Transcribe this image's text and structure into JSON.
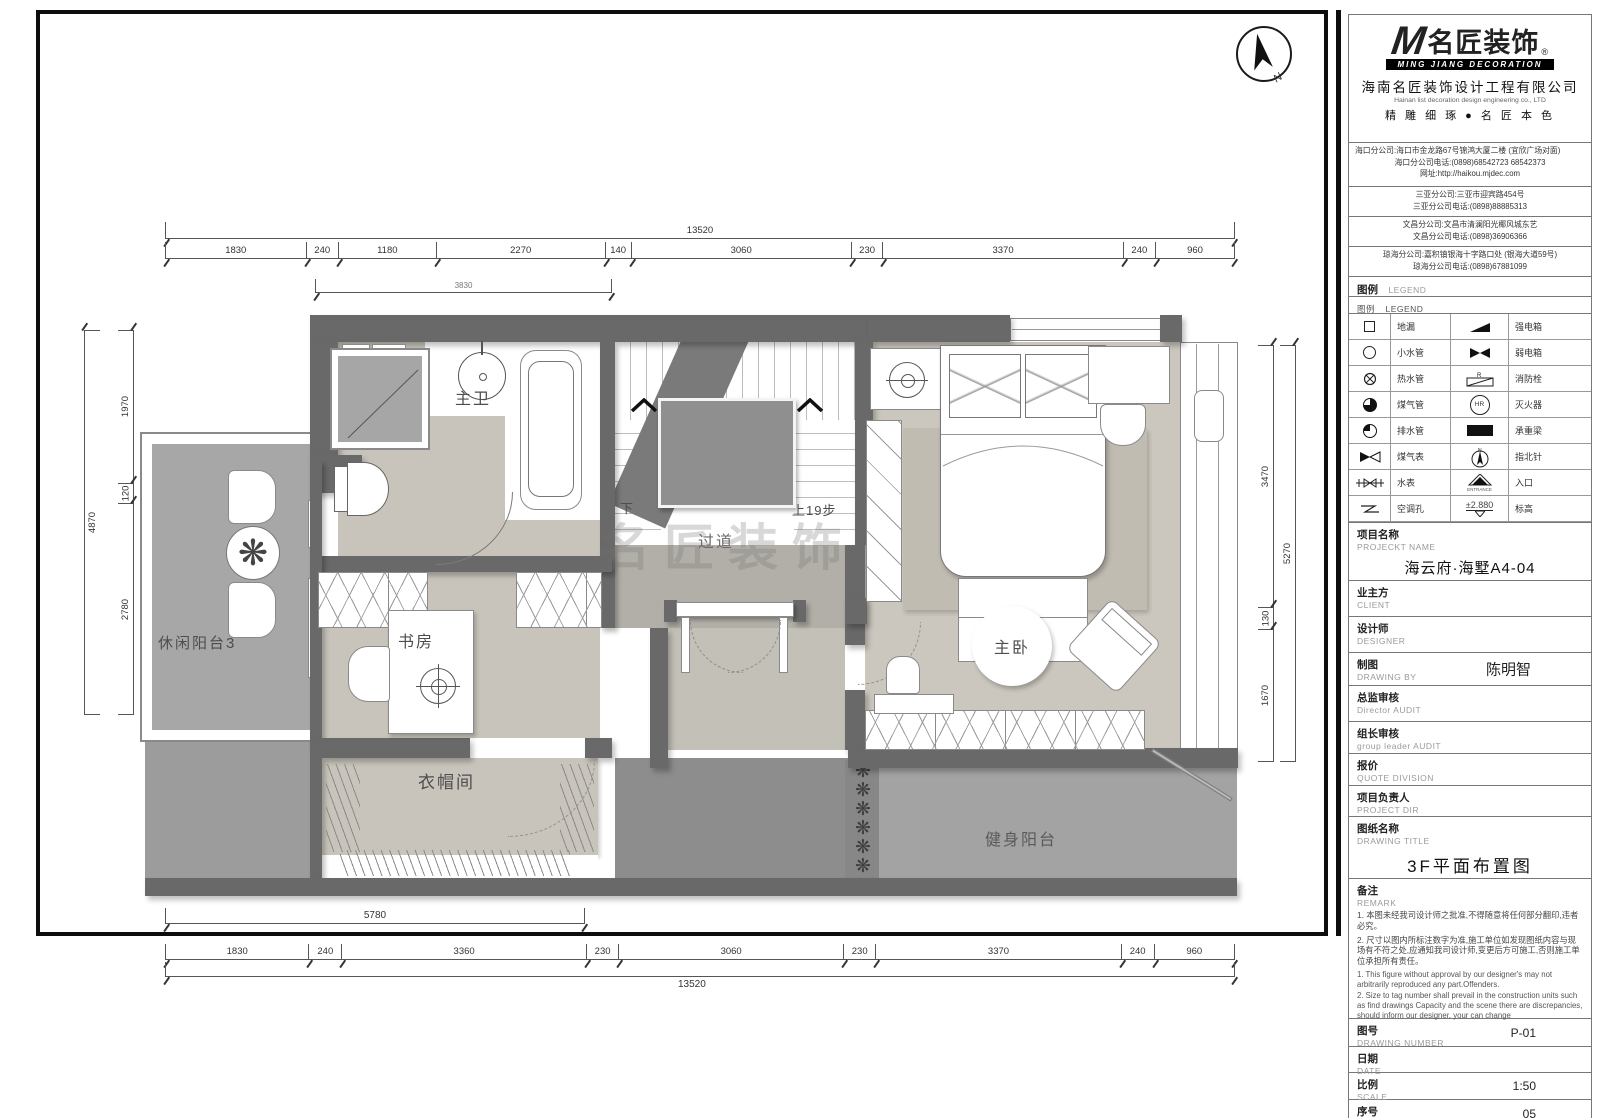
{
  "plan": {
    "watermark": "名匠装饰",
    "rooms": {
      "master_bath": "主卫",
      "corridor": "过道",
      "master_bedroom": "主卧",
      "study": "书房",
      "cloakroom": "衣帽间",
      "leisure_balcony": "休闲阳台3",
      "fitness_balcony": "健身阳台"
    },
    "stairs": {
      "down": "下",
      "up": "上19步"
    },
    "compass_n": "N",
    "icons": {
      "plant_glyph": "❋",
      "plant_strip_glyph": "❋❋❋❋❋❋"
    },
    "dims": {
      "top_total": "13520",
      "top_segments": [
        "1830",
        "240",
        "1180",
        "2270",
        "140",
        "3060",
        "230",
        "3370",
        "240",
        "960"
      ],
      "top_partial": "3830",
      "bottom_partial": "5780",
      "bottom_segments": [
        "1830",
        "240",
        "3360",
        "230",
        "3060",
        "230",
        "3370",
        "240",
        "960"
      ],
      "bottom_total": "13520",
      "left_total": "4870",
      "left_segments": [
        "1970",
        "120",
        "2780"
      ],
      "right_total": "5270",
      "right_segments": [
        "3470",
        "130",
        "1670"
      ]
    }
  },
  "titleblock": {
    "logo": {
      "m": "M",
      "name": "名匠装饰",
      "reg": "®",
      "sub": "MING JIANG DECORATION"
    },
    "company": "海南名匠装饰设计工程有限公司",
    "company_en": "Hainan list decoration design engineering co., LTD",
    "slogan": "精 雕 细 琢 ● 名 匠 本 色",
    "branches": [
      {
        "l1": "海口分公司:海口市金龙路67号锦鸿大厦二楼 (宜欣广场对面)",
        "l2": "海口分公司电话:(0898)68542723 68542373",
        "l3": "网址:http://haikou.mjdec.com"
      },
      {
        "l1": "三亚分公司:三亚市迎宾路454号",
        "l2": "三亚分公司电话:(0898)88885313",
        "l3": ""
      },
      {
        "l1": "文昌分公司:文昌市清澜阳光椰风城东艺",
        "l2": "文昌分公司电话:(0898)36906366",
        "l3": ""
      },
      {
        "l1": "琼海分公司:嘉积镇银海十字路口处 (银海大道59号)",
        "l2": "琼海分公司电话:(0898)67881099",
        "l3": ""
      }
    ],
    "legend_header": {
      "zh": "图例",
      "en": "LEGEND"
    },
    "legend_rows": [
      {
        "left": "地漏",
        "right": "强电箱"
      },
      {
        "left": "小水管",
        "right": "弱电箱"
      },
      {
        "left": "热水管",
        "right": "消防栓"
      },
      {
        "left": "煤气管",
        "right": "灭火器"
      },
      {
        "left": "排水管",
        "right": "承重梁"
      },
      {
        "left": "煤气表",
        "right": "指北针"
      },
      {
        "left": "水表",
        "right": "入口"
      },
      {
        "left": "空调孔",
        "right": "标高"
      }
    ],
    "legend_values": {
      "elevation": "±2.880",
      "hr": "HR",
      "r": "R",
      "entrance": "ENTRANCE",
      "n": "N"
    },
    "project": {
      "zh": "项目名称",
      "en": "PROJECKT NAME",
      "value": "海云府·海墅A4-04"
    },
    "client": {
      "zh": "业主方",
      "en": "CLIENT",
      "value": ""
    },
    "designer": {
      "zh": "设计师",
      "en": "DESIGNER",
      "value": ""
    },
    "drawing_by": {
      "zh": "制图",
      "en": "DRAWING BY",
      "value": "陈明智"
    },
    "director_audit": {
      "zh": "总监审核",
      "en": "Director AUDIT",
      "value": ""
    },
    "leader_audit": {
      "zh": "组长审核",
      "en": "group leader AUDIT",
      "value": ""
    },
    "quote": {
      "zh": "报价",
      "en": "QUOTE DIVISION",
      "value": ""
    },
    "project_dir": {
      "zh": "项目负责人",
      "en": "PROJECT DIR",
      "value": ""
    },
    "drawing_title": {
      "zh": "图纸名称",
      "en": "DRAWING TITLE",
      "value": "3F平面布置图"
    },
    "remark": {
      "zh": "备注",
      "en": "REMARK",
      "zh1": "1. 本图未经我司设计师之批准,不得随意将任何部分翻印,违者必究。",
      "zh2": "2. 尺寸以图内所标注数字为准,施工单位如发现图纸内容与现场有不符之处,应通知我司设计师,变更后方可施工,否则施工单位承担所有责任。",
      "en1": "1. This figure without approval by our designer's may not arbitrarily reproduced any part.Offenders.",
      "en2": "2. Size to tag number shall prevail in the construction units such as find drawings Capacity and the scene there are discrepancies, should inform our designer, your can change"
    },
    "drawing_number": {
      "zh": "图号",
      "en": "DRAWING NUMBER",
      "value": "P-01"
    },
    "date": {
      "zh": "日期",
      "en": "DATE",
      "value": ""
    },
    "scale": {
      "zh": "比例",
      "en": "SCALE",
      "value": "1:50"
    },
    "number": {
      "zh": "序号",
      "en": "NUMBER",
      "value": "05"
    }
  }
}
